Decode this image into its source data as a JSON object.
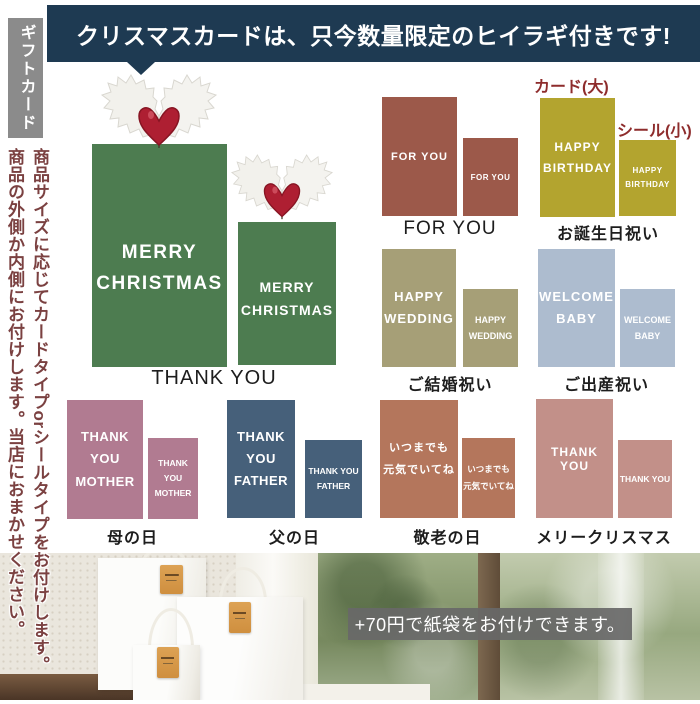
{
  "banner": {
    "text": "クリスマスカードは、只今数量限定のヒイラギ付きです!"
  },
  "sidebar": {
    "tab": "ギフトカード",
    "note_line1": "商品サイズに応じてカードタイプorシールタイプをお付けします。",
    "note_line2": "商品の外側か内側にお付けします。当店におまかせください。"
  },
  "annotations": {
    "card_large": "カード(大)",
    "seal_small": "シール(小)"
  },
  "sections": {
    "christmas": {
      "label": "THANK YOU",
      "card_line1": "MERRY",
      "card_line2": "CHRISTMAS",
      "color": "#4d7c50"
    },
    "for_you": {
      "label": "FOR YOU",
      "card_line1": "FOR YOU",
      "color": "#9c594a"
    },
    "birthday": {
      "label": "お誕生日祝い",
      "card_line1": "HAPPY",
      "card_line2": "BIRTHDAY",
      "color": "#b3a42f"
    },
    "wedding": {
      "label": "ご結婚祝い",
      "card_line1": "HAPPY",
      "card_line2": "WEDDING",
      "color": "#a69f77"
    },
    "baby": {
      "label": "ご出産祝い",
      "card_line1": "WELCOME",
      "card_line2": "BABY",
      "color": "#adbccf"
    },
    "mother": {
      "label": "母の日",
      "card_line1": "THANK YOU",
      "card_line2": "MOTHER",
      "color": "#b17b91"
    },
    "father": {
      "label": "父の日",
      "card_line1": "THANK YOU",
      "card_line2": "FATHER",
      "color": "#46607a"
    },
    "respect": {
      "label": "敬老の日",
      "card_line1": "いつまでも",
      "card_line2": "元気でいてね",
      "color": "#b4765c"
    },
    "merry_christmas": {
      "label": "メリークリスマス",
      "card_line1": "THANK YOU",
      "color": "#c29089"
    }
  },
  "photo": {
    "caption": "+70円で紙袋をお付けできます。"
  },
  "colors": {
    "banner_bg": "#1e3a52",
    "tab_bg": "#8b8b8b",
    "annotation_red": "#8e2c2c",
    "note_text": "#7b4141",
    "holly_berry": "#ae1f32"
  }
}
